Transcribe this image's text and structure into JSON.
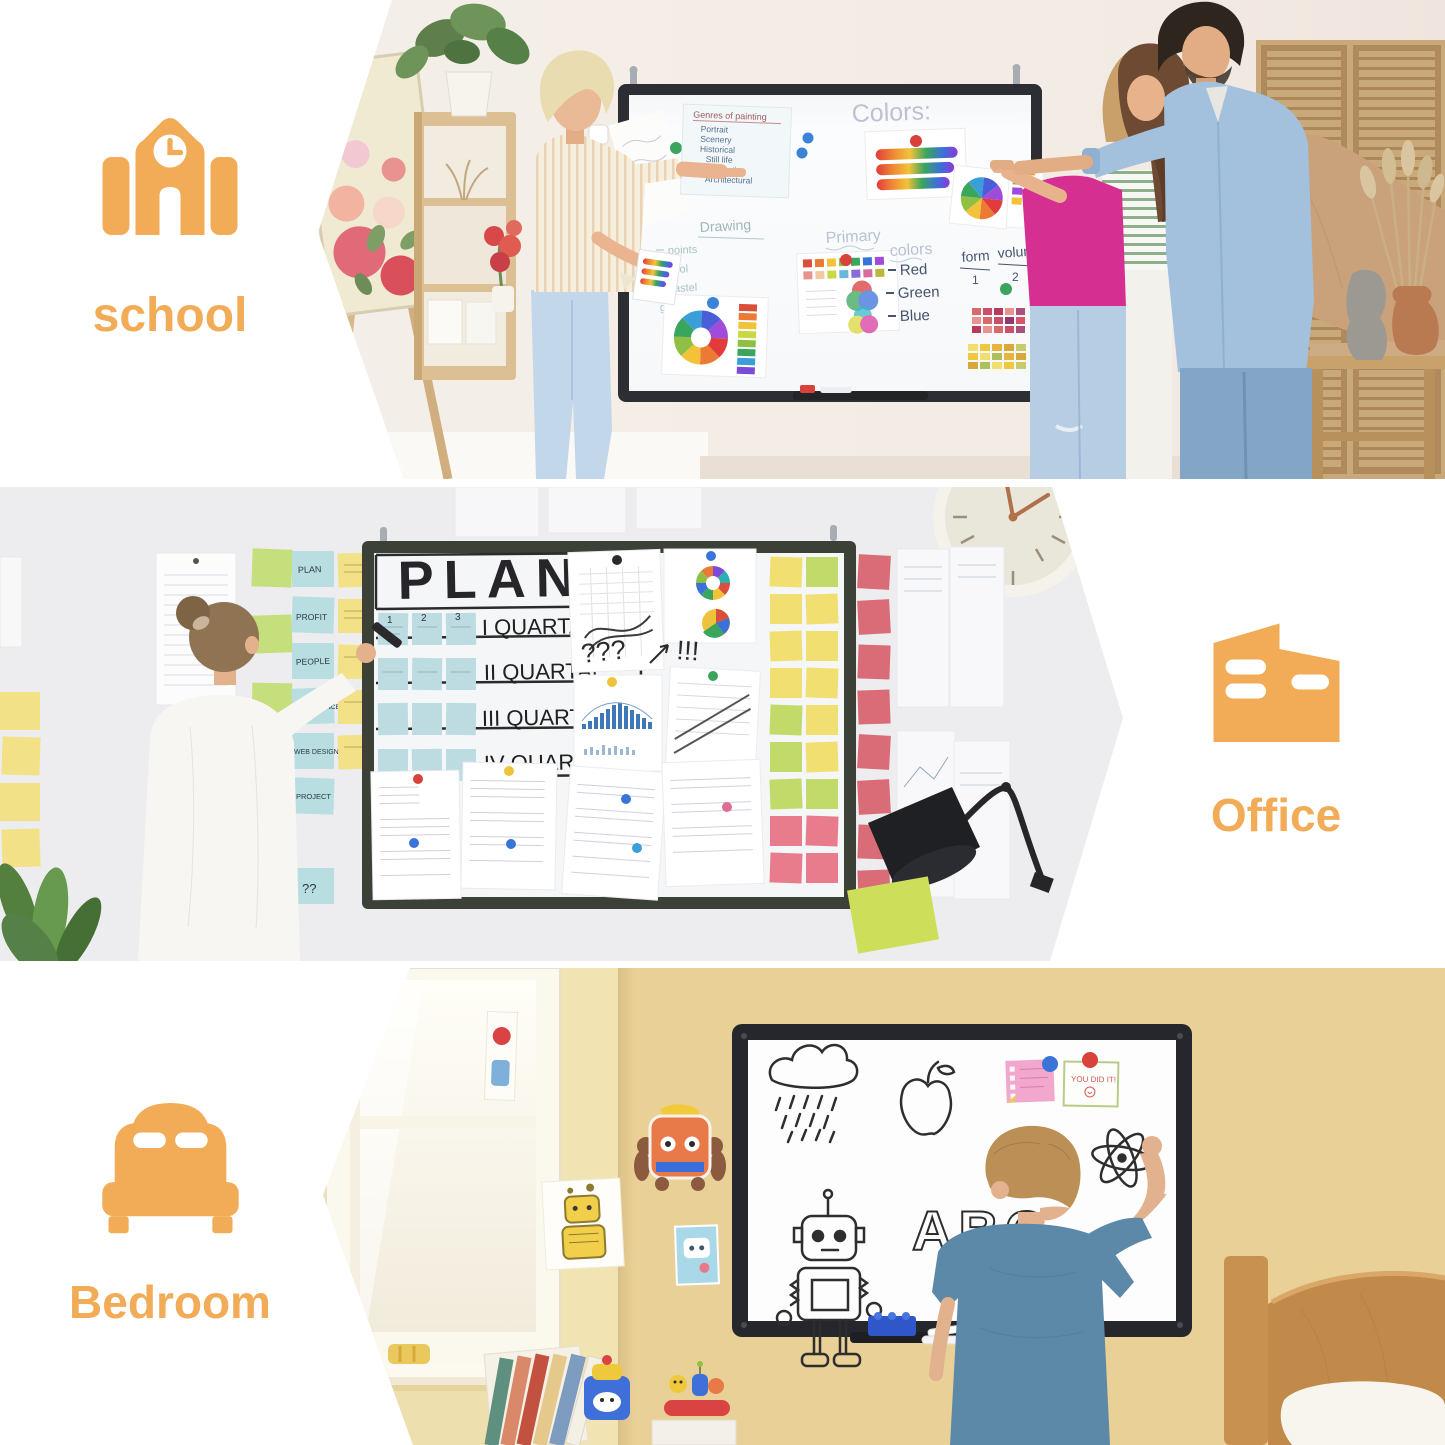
{
  "accent_color": "#F2AB56",
  "palette": {
    "school_wall": "#F4EFE9",
    "office_wall": "#EDEDF0",
    "bedroom_wall_left": "#F2E4B2",
    "bedroom_wall_right": "#E9D096",
    "board_frame_dark": "#2C2E33"
  },
  "sections": [
    {
      "label": "school"
    },
    {
      "label": "Office"
    },
    {
      "label": "Bedroom"
    }
  ],
  "school": {
    "board_title": "Colors:",
    "genres_title": "Genres of painting",
    "genres": [
      "Portrait",
      "Scenery",
      "Historical",
      "Still life",
      "Domestic",
      "Architectural"
    ],
    "drawing_title": "Drawing",
    "drawing_items": [
      "points",
      "cool",
      "pastel",
      "graphite pencil"
    ],
    "primary_word_1": "Primary",
    "primary_word_2": "colors",
    "primary_items": [
      "Red",
      "Green",
      "Blue"
    ],
    "form_label": "form",
    "volume_label": "volume",
    "form_value": "1",
    "volume_value": "2"
  },
  "office": {
    "board_title": "PLAN",
    "row_numbers": [
      "1",
      "2",
      "3"
    ],
    "rows": [
      "I QUARTAL",
      "II QUARTAL",
      "III QUARTAL",
      "IV QUARTAL"
    ],
    "marks": [
      "???",
      "!!!"
    ],
    "stickies": [
      "PLAN",
      "PROFIT",
      "PEOPLE",
      "LIFE BALANCE",
      "WEB DESIGN",
      "PROJECT",
      "??"
    ]
  },
  "bedroom": {
    "board_text": "ABC",
    "note_text": "YOU DID IT!"
  }
}
